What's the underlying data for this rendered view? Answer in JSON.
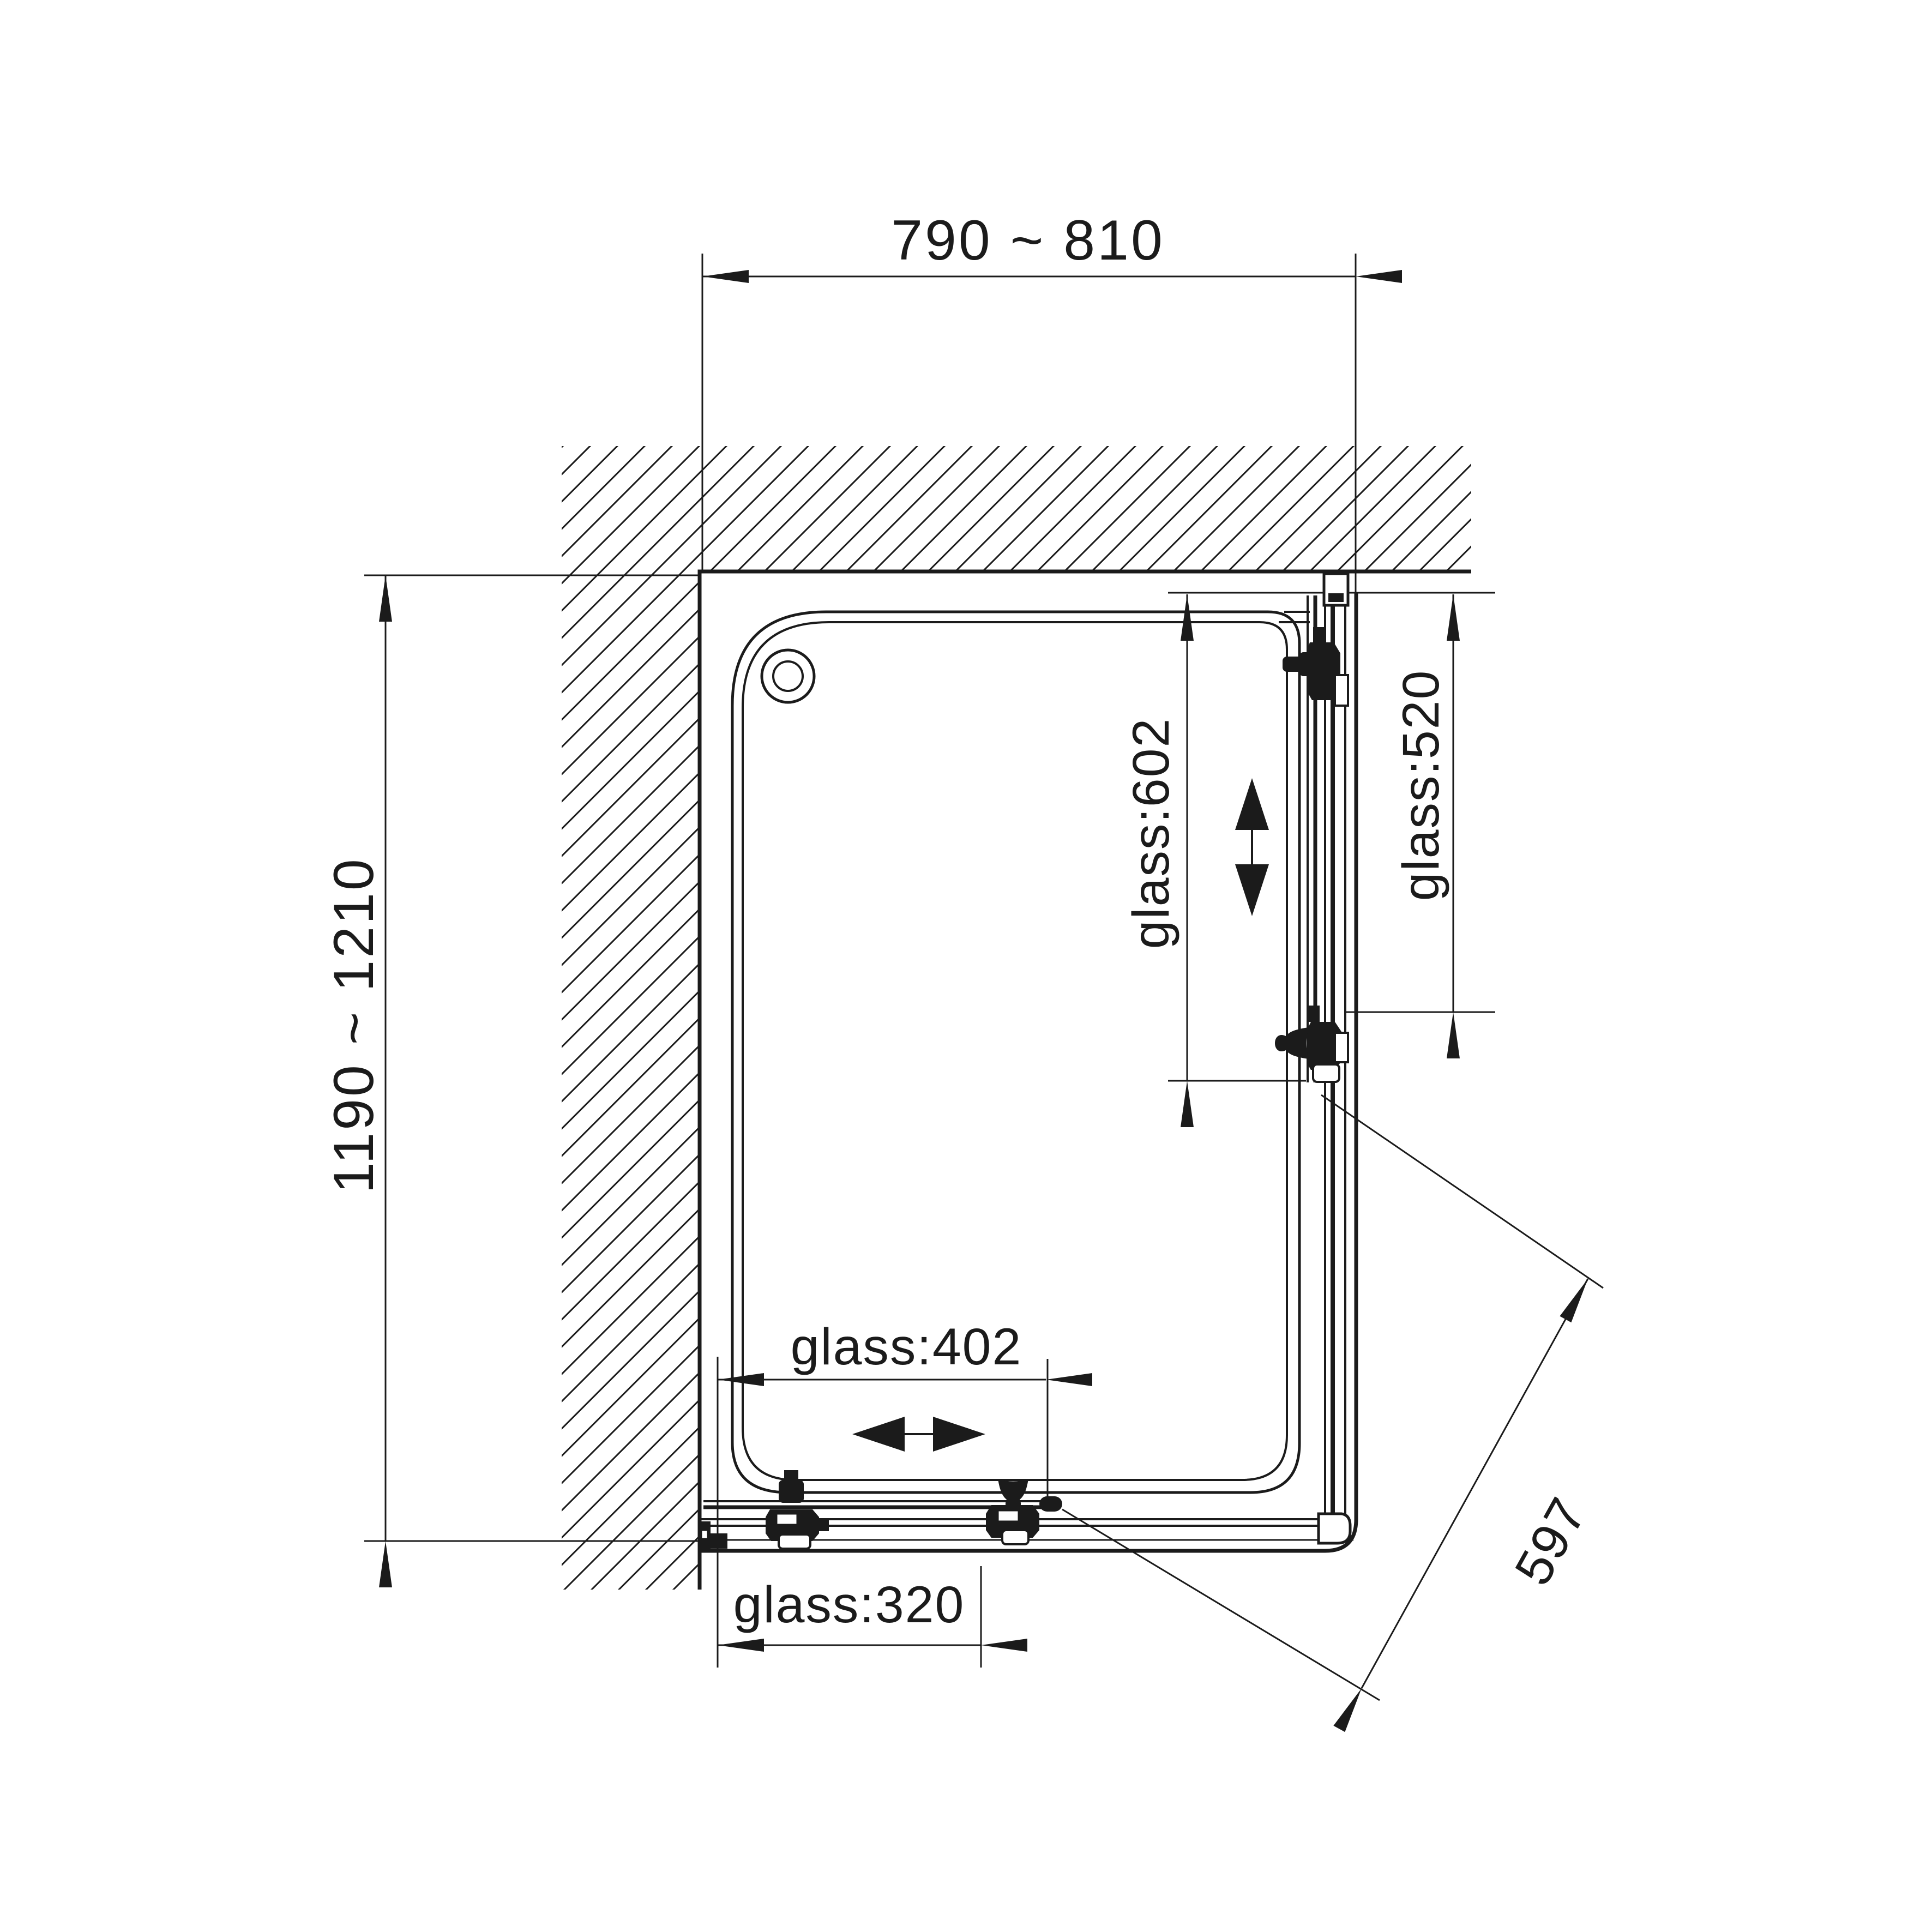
{
  "drawing": {
    "kind": "shower-enclosure-plan-view",
    "background_color": "#ffffff",
    "line_color": "#1b1b1b",
    "labels": {
      "width_top": "790 ~ 810",
      "depth_left": "1190 ~ 1210",
      "glass_right_inner": "glass:602",
      "glass_right_outer": "glass:520",
      "glass_bottom_inner": "glass:402",
      "glass_bottom_outer": "glass:320",
      "diagonal_opening": "597"
    }
  }
}
